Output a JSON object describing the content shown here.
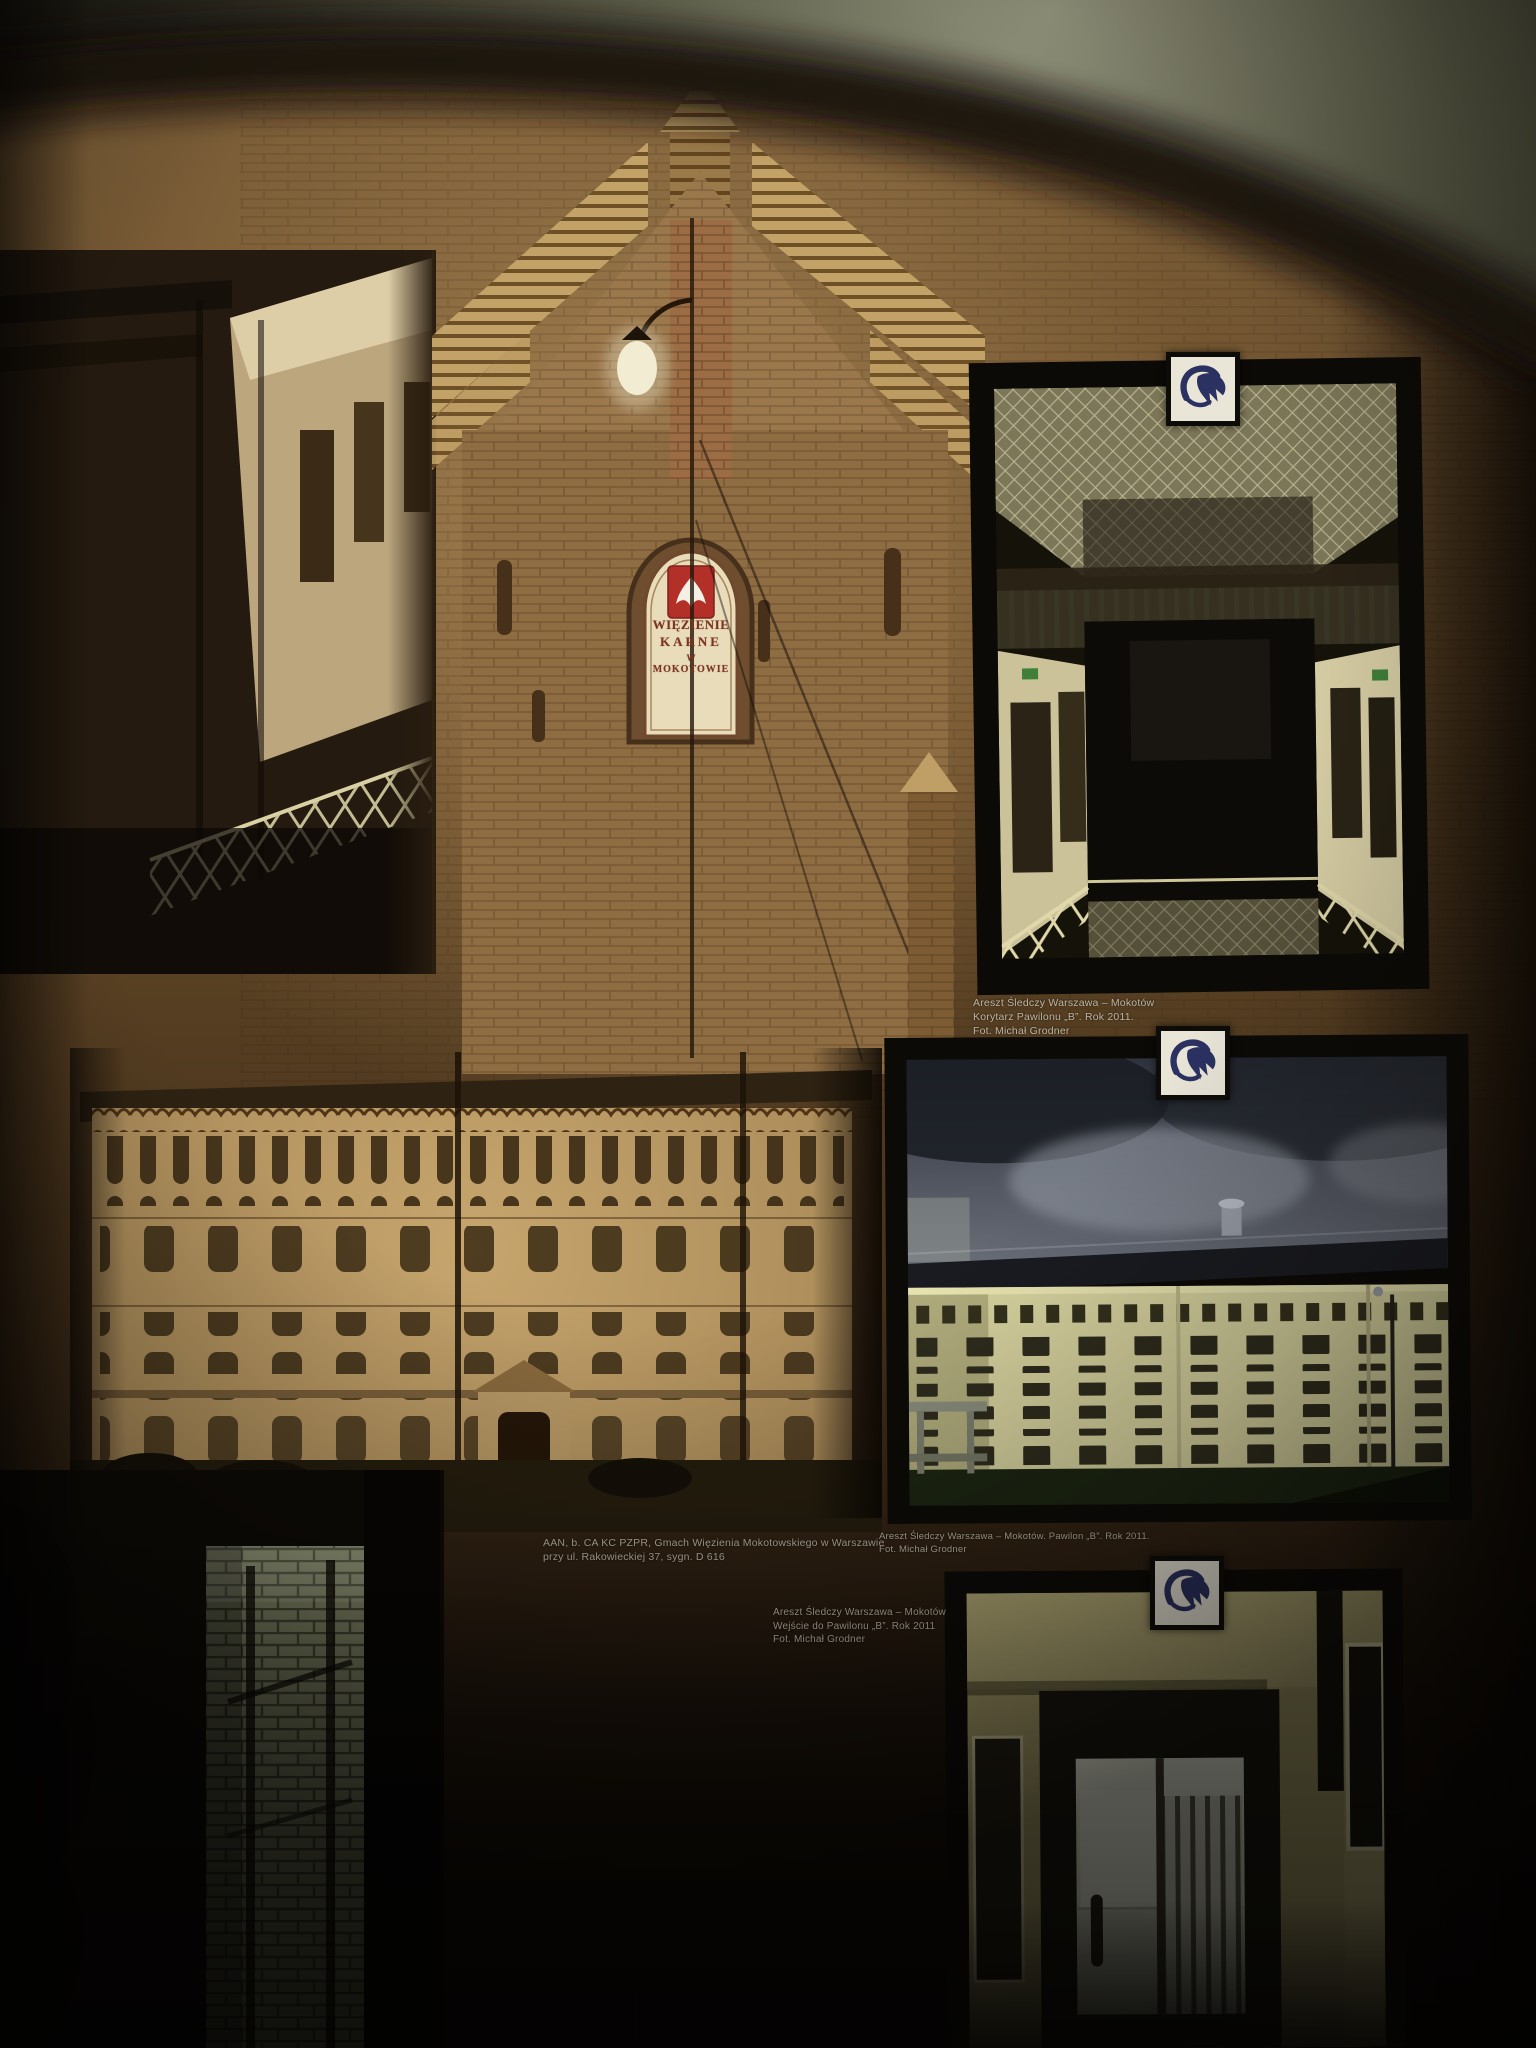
{
  "scene": {
    "description": "Photograph of a museum exhibition wall about Mokotów Prison in Warsaw: a sepia historical mural with an arched top, three framed colour photographs with Polish Prison Service (SW) logo badges, and small white printed captions."
  },
  "mural": {
    "sign_lines": [
      "WIĘZIENIE",
      "KARNE",
      "W",
      "MOKOTOWIE"
    ],
    "sign_emblem": "white-eagle-on-red-plaque",
    "caption_lines": [
      "AAN, b. CA KC PZPR, Gmach Więzienia Mokotowskiego w Warszawie",
      "przy ul. Rakowieckiej 37, sygn. D 616"
    ]
  },
  "photos": {
    "corridor": {
      "caption_lines": [
        "Areszt Śledczy Warszawa – Mokotów",
        "Korytarz Pawilonu „B”. Rok 2011.",
        "Fot. Michał Grodner"
      ]
    },
    "pavilion": {
      "caption_lines": [
        "Areszt Śledczy Warszawa – Mokotów. Pawilon „B”. Rok 2011.",
        "Fot. Michał Grodner"
      ]
    },
    "entrance": {
      "caption_lines": [
        "Areszt Śledczy Warszawa – Mokotów",
        "Wejście do Pawilonu „B”. Rok 2011",
        "Fot. Michał Grodner"
      ]
    }
  },
  "logo": {
    "name": "sw-prison-service-logo",
    "glyph": "stylized SW bird",
    "color": "#2b3161",
    "background": "#e9e6d8"
  },
  "colors": {
    "wall_top_glow": "#8f9077",
    "mural_brown": "#7b5e38",
    "badge_navy": "#2b3161",
    "sign_red": "#b23028",
    "sign_cream": "#e8dcba",
    "caption_text": "#c8c2b0",
    "yellow_facade": "#d8d4a0",
    "corridor_wall": "#cbc29a"
  }
}
